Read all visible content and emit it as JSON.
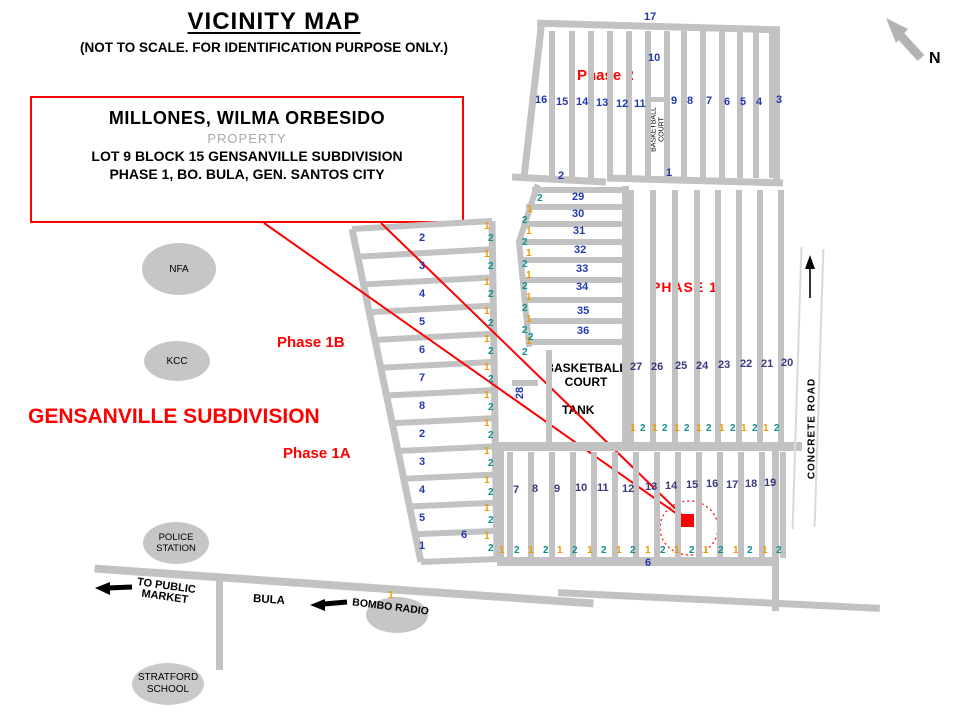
{
  "title": {
    "heading": "VICINITY MAP",
    "subheading": "(NOT TO SCALE. FOR IDENTIFICATION PURPOSE ONLY.)"
  },
  "north": {
    "label": "N"
  },
  "property_box": {
    "owner": "MILLONES, WILMA ORBESIDO",
    "type": "PROPERTY",
    "address_line1": "LOT 9  BLOCK 15 GENSANVILLE SUBDIVISION",
    "address_line2": "PHASE 1, BO. BULA,  GEN. SANTOS CITY"
  },
  "area_labels": {
    "subdivision": "GENSANVILLE SUBDIVISION",
    "phase_2": "Phase 2",
    "phase_1": "PHASE 1",
    "phase_1b": "Phase 1B",
    "phase_1a": "Phase 1A"
  },
  "landmarks": {
    "nfa": "NFA",
    "kcc": "KCC",
    "police_station_line1": "POLICE",
    "police_station_line2": "STATION",
    "stratford_line1": "STRATFORD",
    "stratford_line2": "SCHOOL",
    "bombo_radio": "BOMBO RADIO",
    "bula": "BULA",
    "to_public_market_line1": "TO PUBLIC",
    "to_public_market_line2": "MARKET",
    "tank": "TANK",
    "basketball_line1": "BASKETBALL",
    "basketball_line2": "COURT",
    "basketball_small_line1": "BASKETBALL",
    "basketball_small_line2": "COURT",
    "concrete_road": "CONCRETE ROAD"
  },
  "numbers": {
    "phase2_top": "17",
    "phase2_upper": "10",
    "phase2_row": [
      "16",
      "15",
      "14",
      "13",
      "12",
      "11",
      "9",
      "8",
      "7",
      "6",
      "5",
      "4",
      "3"
    ],
    "phase2_bottom_left": "2",
    "phase2_bottom_right": "1",
    "mid_rows": [
      "29",
      "30",
      "31",
      "32",
      "33",
      "34",
      "35",
      "36"
    ],
    "mid_pairs": [
      "2",
      "1",
      "2",
      "1",
      "2",
      "1",
      "2",
      "1",
      "2",
      "1",
      "2",
      "1",
      "2",
      "1",
      "2"
    ],
    "rotated_28": "28",
    "extra_two": "2",
    "block20_row": [
      "27",
      "26",
      "25",
      "24",
      "23",
      "22",
      "21",
      "20"
    ],
    "block20_pairs": [
      "1",
      "2",
      "1",
      "2",
      "1",
      "2",
      "1",
      "2",
      "1",
      "2",
      "1",
      "2",
      "1",
      "2"
    ],
    "lower_row": [
      "7",
      "8",
      "9",
      "10",
      "11",
      "12",
      "13",
      "14",
      "15",
      "16",
      "17",
      "18",
      "19"
    ],
    "lower_pairs": [
      "1",
      "2",
      "1",
      "2",
      "1",
      "2",
      "1",
      "2",
      "1",
      "2",
      "1",
      "2",
      "1",
      "2",
      "1",
      "2",
      "1",
      "2",
      "1",
      "2"
    ],
    "lower_six": "6",
    "ladder_rows": [
      "2",
      "3",
      "4",
      "5",
      "6",
      "7",
      "8",
      "2",
      "3",
      "4",
      "5",
      "1"
    ],
    "ladder_pairs": [
      "1",
      "2",
      "1",
      "2",
      "1",
      "2",
      "1",
      "2",
      "1",
      "2",
      "1",
      "2",
      "1",
      "2",
      "1",
      "2",
      "1",
      "2",
      "1",
      "2",
      "1",
      "2",
      "1",
      "2"
    ],
    "ladder_last": "6",
    "bombo_one": "1"
  },
  "colors": {
    "road_gray": "#c2c2c2",
    "accent_red": "#fe0000",
    "lot_blue": "#2438ad",
    "lot_slate": "#3a3a80",
    "lot_orange": "#ee9a00",
    "lot_teal": "#0d9090"
  }
}
